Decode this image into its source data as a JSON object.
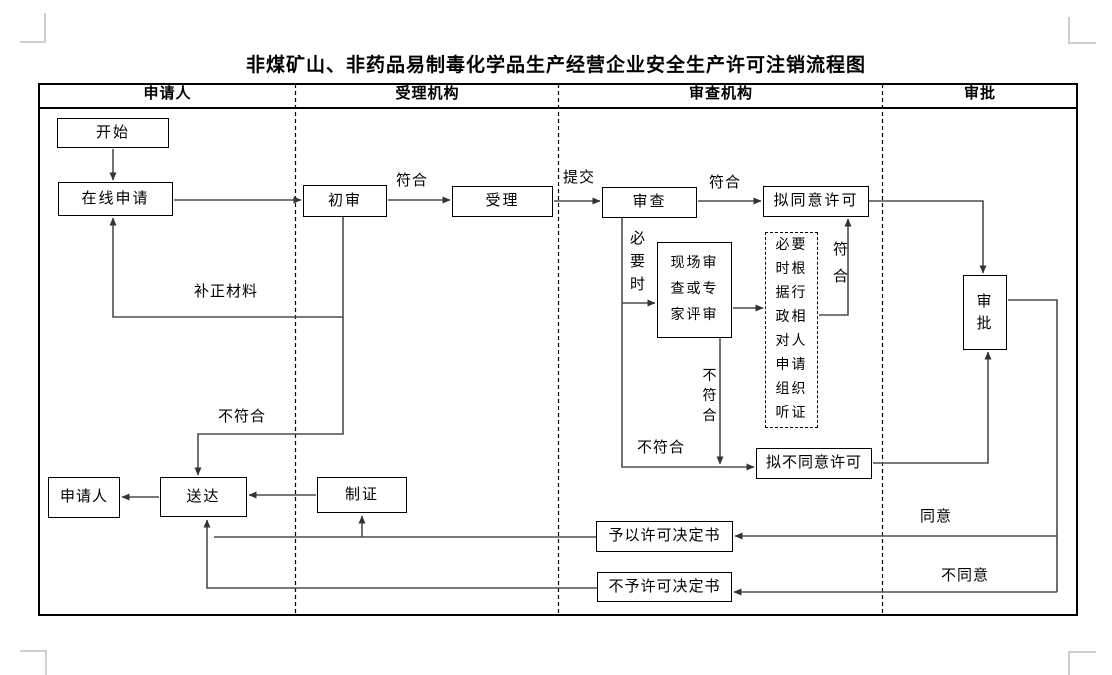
{
  "title": "非煤矿山、非药品易制毒化学品生产经营企业安全生产许可注销流程图",
  "lanes": [
    {
      "label": "申请人"
    },
    {
      "label": "受理机构"
    },
    {
      "label": "审查机构"
    },
    {
      "label": "审批"
    }
  ],
  "nodes": {
    "start": "开始",
    "online_apply": "在线申请",
    "initial_review": "初审",
    "accept": "受理",
    "review": "审查",
    "propose_approve": "拟同意许可",
    "site_review": "现场审查或专家评审",
    "hearing": "必要时根据行政相对人申请组织听证",
    "approval": "审批",
    "propose_deny": "拟不同意许可",
    "applicant": "申请人",
    "deliver": "送达",
    "make_cert": "制证",
    "grant_decision": "予以许可决定书",
    "deny_decision": "不予许可决定书"
  },
  "labels": {
    "conform_1": "符合",
    "submit": "提交",
    "conform_2": "符合",
    "conform_3": "符合",
    "supplement": "补正材料",
    "not_conform_1": "不符合",
    "when_necessary": "必要时",
    "not_conform_2": "不符合",
    "not_conform_3": "不符合",
    "agree": "同意",
    "disagree": "不同意"
  },
  "colors": {
    "line": "#4d4d4d",
    "border": "#000000",
    "crop_mark": "#c0c0c0"
  }
}
